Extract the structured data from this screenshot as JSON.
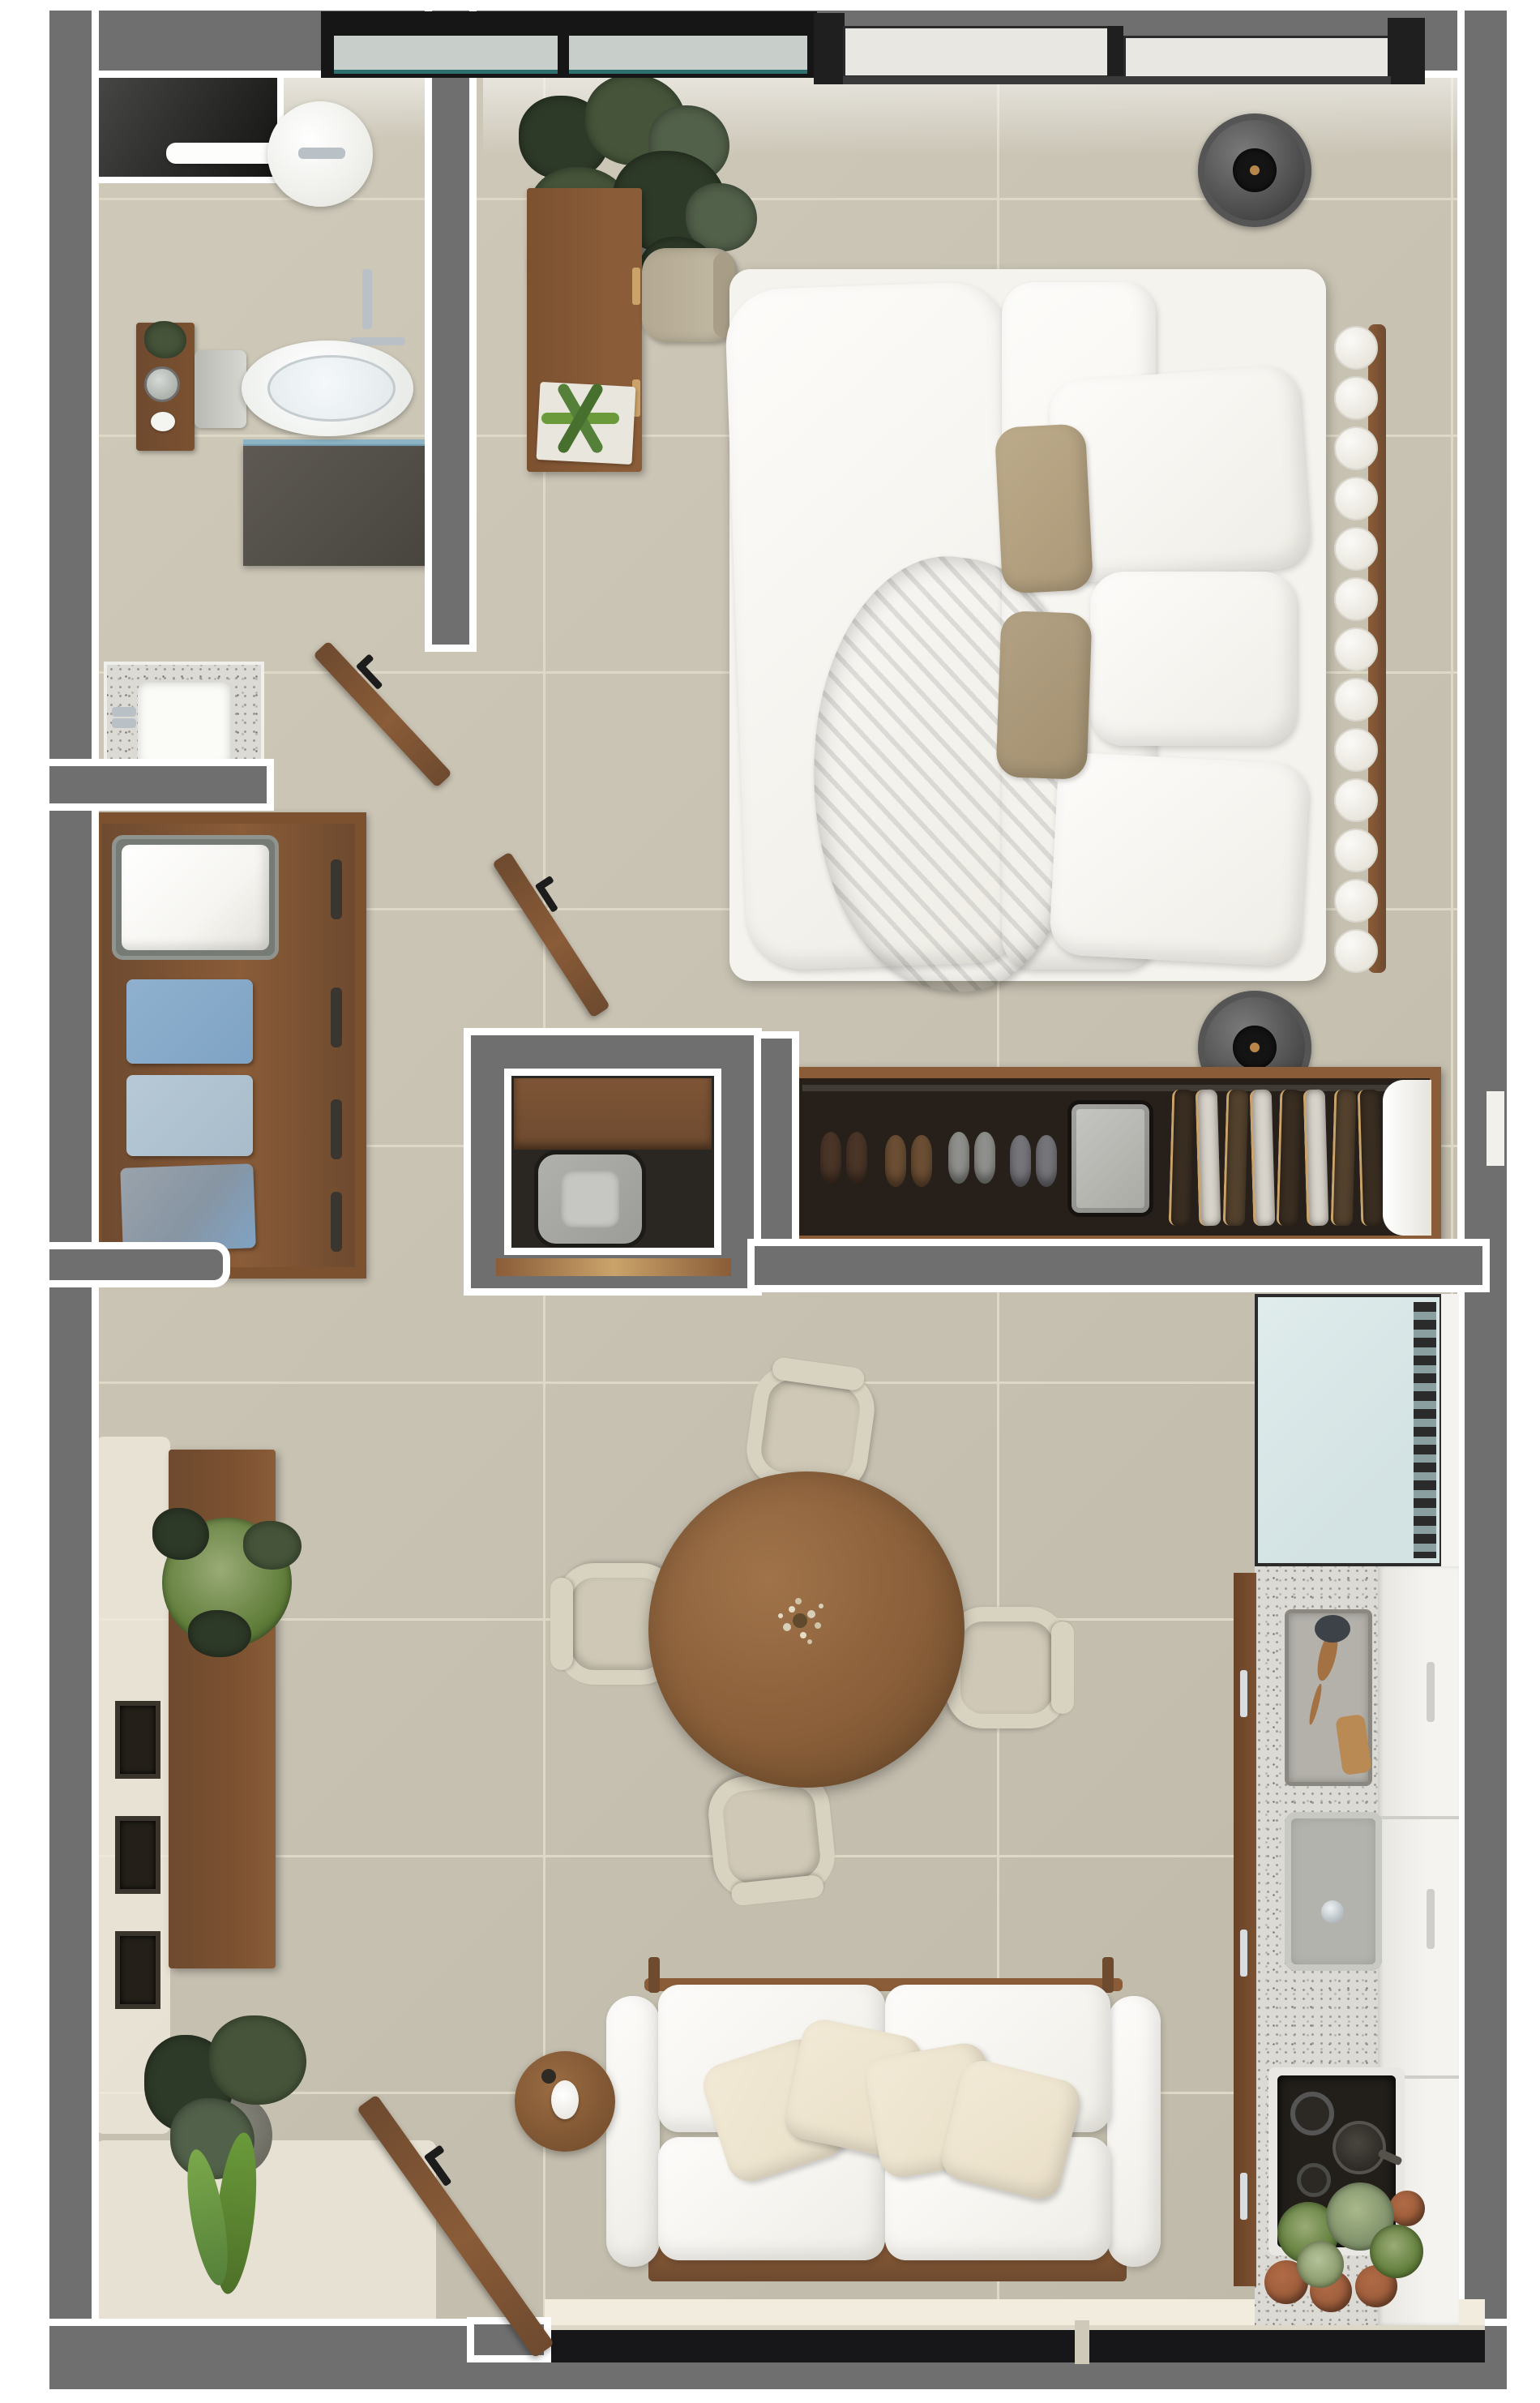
{
  "palette": {
    "bg": "#ffffff",
    "wall": "#6f6f6f",
    "outline": "#ffffff",
    "floor": "#cbc5b4",
    "grout": "#ded8c7",
    "floor-light": "#f2ecdf",
    "wood": "#8a5c38",
    "wood-dark": "#6e4a2f",
    "wood-deep": "#7b5130",
    "wood-light": "#caa36a",
    "glass-dark": "#17171a",
    "glass-teal": "#2e6f6f",
    "window-pane": "#c8cec9",
    "window-cream": "#e9e7e1",
    "cream": "#f2ecdf",
    "white-soft": "#f4f2ec",
    "cushion": "#e9dfc8",
    "cushion-light": "#f4eedd",
    "chair": "#d8d2c0",
    "chair-seat": "#cfc8b6",
    "granite": "#dcdad4",
    "steel": "#b9c1c7",
    "appliance": "#9c9c98",
    "fridge": "#d3e2e3",
    "dark": "#241f1a",
    "plant-dark": "#2e3a28",
    "plant": "#46553a",
    "plant-mid": "#52614a",
    "plant-bright": "#6a9a3a",
    "succulent": "#5e7c38",
    "towel-white": "#f6f5f1",
    "towel-blue": "#7fa3c4",
    "towel-lightblue": "#a8bccb",
    "towel-gray": "#8795a3",
    "towel-slate": "#9aa3ab",
    "garment-dark": "#3a2e22",
    "garment-light": "#d9d4cb",
    "garment-brown": "#54422e",
    "shoe-dark": "#4a3527",
    "shoe-brown": "#6b4e33",
    "shoe-gray": "#8f8f8c",
    "shoe-slate": "#75757a",
    "tan": "#ab9878",
    "tan-dark": "#a29070",
    "throw": "#a89274",
    "terracotta": "#9a5b3a",
    "bed-white": "#f5f3ee"
  },
  "floorplan": {
    "scene": "3d-rendered top-down one-bedroom apartment floor plan",
    "rooms": [
      {
        "name": "bathroom",
        "items": [
          "shower-niche",
          "rain-shower-head",
          "shower-fixtures",
          "floating-counter",
          "toilet",
          "wood-shelf",
          "shelf-plant",
          "round-mirror",
          "granite-vanity",
          "sink",
          "window"
        ]
      },
      {
        "name": "bedroom",
        "items": [
          "double-bed",
          "bobble-headboard",
          "white-duvet",
          "euro-pillow",
          "white-pillows",
          "tan-accent-pillows",
          "tan-throw-blanket",
          "bedside-speaker-top",
          "bedside-speaker-bottom",
          "desk",
          "desk-chair",
          "fiddle-leaf-plant",
          "aloe-plant",
          "papers",
          "windows"
        ]
      },
      {
        "name": "hallway",
        "items": [
          "bathroom-door",
          "bedroom-door"
        ]
      },
      {
        "name": "linen-closet",
        "items": [
          "wood-shelf-unit",
          "wire-basket-towel",
          "blue-towel",
          "lightblue-towel",
          "graylue-towel",
          "gray-towel"
        ]
      },
      {
        "name": "laundry-closet",
        "items": [
          "wood-shelf",
          "washing-machine",
          "wood-threshold"
        ]
      },
      {
        "name": "wardrobe",
        "items": [
          "shoe-pairs",
          "storage-bin",
          "hanging-clothes-rail",
          "end-panel"
        ]
      },
      {
        "name": "living-dining",
        "items": [
          "round-dining-table",
          "flower-centerpiece",
          "dining-chairs-x4",
          "sofa",
          "sofa-pillows-x4",
          "round-side-table",
          "candle",
          "console-sideboard",
          "succulent-plant",
          "wall-frames-x3",
          "corner-plant",
          "entry-door",
          "window-wall"
        ]
      },
      {
        "name": "kitchen",
        "items": [
          "refrigerator",
          "vent-grille",
          "granite-counter",
          "utensil-tray",
          "wooden-spoon",
          "cutting-board",
          "sink",
          "faucet",
          "cooktop",
          "pan",
          "cabinet-fronts",
          "cabinet-handles",
          "potted-plants",
          "terracotta-pots"
        ]
      }
    ]
  }
}
